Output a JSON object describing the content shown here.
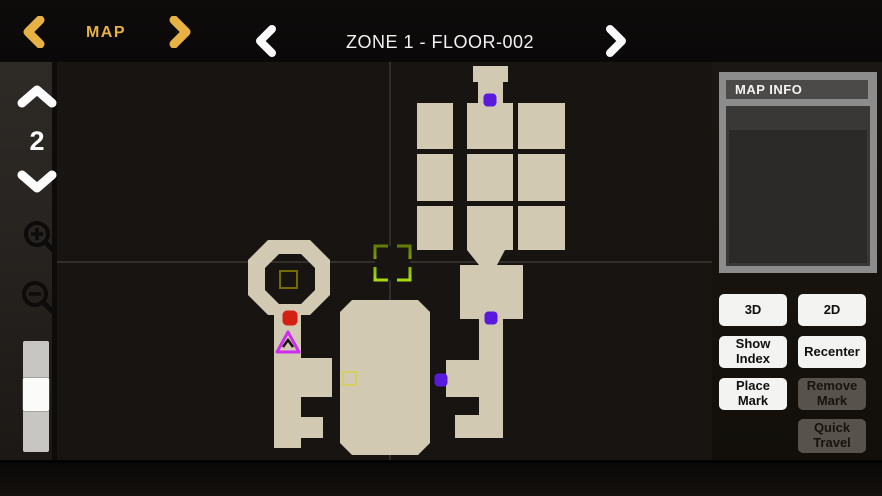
{
  "topbar": {
    "menu_label": "MAP",
    "floor_title": "ZONE 1 - FLOOR-002"
  },
  "sidebar": {
    "floor_number": "2"
  },
  "map_info": {
    "title": "MAP INFO"
  },
  "buttons": {
    "view_3d": "3D",
    "view_2d": "2D",
    "show_index": "Show Index",
    "recenter": "Recenter",
    "place_mark": "Place Mark",
    "remove_mark": "Remove Mark",
    "quick_travel": "Quick Travel"
  },
  "icons": {
    "topbar_left": "chevron-left",
    "topbar_right": "chevron-right",
    "floor_up": "chevron-up",
    "floor_down": "chevron-down",
    "zoom_in": "magnifier-plus",
    "zoom_out": "magnifier-minus"
  },
  "colors": {
    "accent_gold": "#e7b243",
    "room_fill": "#d2c9b3",
    "map_background": "#171411",
    "red_mark": "#d32013",
    "purple_mark": "#5a1add",
    "triangle_mark": "#cf2cf2",
    "selection_top": "#637d04",
    "selection_bottom": "#a7d911",
    "olive_square": "#746c00",
    "yellow_square": "#d8cf4a",
    "crosshair": "rgba(215,210,198,0.28)"
  },
  "map": {
    "viewport": {
      "w": 655,
      "h": 398
    },
    "crosshair": {
      "x": 333,
      "y": 200
    },
    "rooms": [
      {
        "type": "rect",
        "x": 416,
        "y": 4,
        "w": 35,
        "h": 16
      },
      {
        "type": "rect",
        "x": 421,
        "y": 20,
        "w": 25,
        "h": 21
      },
      {
        "type": "rect",
        "x": 360,
        "y": 41,
        "w": 36,
        "h": 46
      },
      {
        "type": "rect",
        "x": 410,
        "y": 41,
        "w": 46,
        "h": 46
      },
      {
        "type": "rect",
        "x": 461,
        "y": 41,
        "w": 47,
        "h": 46
      },
      {
        "type": "rect",
        "x": 360,
        "y": 92,
        "w": 36,
        "h": 47
      },
      {
        "type": "rect",
        "x": 410,
        "y": 92,
        "w": 46,
        "h": 47
      },
      {
        "type": "rect",
        "x": 461,
        "y": 92,
        "w": 47,
        "h": 47
      },
      {
        "type": "rect",
        "x": 360,
        "y": 144,
        "w": 36,
        "h": 44
      },
      {
        "type": "rect",
        "x": 410,
        "y": 144,
        "w": 46,
        "h": 44
      },
      {
        "type": "rect",
        "x": 461,
        "y": 144,
        "w": 47,
        "h": 44
      },
      {
        "type": "poly",
        "points": "410,188 448,188 440,203 422,203"
      },
      {
        "type": "rect",
        "x": 403,
        "y": 203,
        "w": 63,
        "h": 54
      },
      {
        "type": "rect",
        "x": 422,
        "y": 255,
        "w": 24,
        "h": 121
      },
      {
        "type": "rect",
        "x": 389,
        "y": 298,
        "w": 34,
        "h": 37
      },
      {
        "type": "rect",
        "x": 398,
        "y": 353,
        "w": 25,
        "h": 23
      },
      {
        "type": "poly",
        "points": "295,238 361,238 373,250 373,381 361,393 295,393 283,381 283,250"
      },
      {
        "type": "rect",
        "x": 217,
        "y": 248,
        "w": 27,
        "h": 138
      },
      {
        "type": "rect",
        "x": 244,
        "y": 296,
        "w": 31,
        "h": 39
      },
      {
        "type": "rect",
        "x": 244,
        "y": 355,
        "w": 22,
        "h": 21
      },
      {
        "type": "poly",
        "points": "211,178 253,178 273,198 273,233 253,253 211,253 191,233 191,198"
      }
    ],
    "holes": [
      {
        "type": "poly",
        "points": "222,192 244,192 258,206 258,228 244,242 222,242 208,228 208,206"
      }
    ],
    "overlays": [
      {
        "kind": "selection",
        "x": 318,
        "y": 184,
        "w": 35,
        "h": 34
      },
      {
        "kind": "square",
        "x": 223,
        "y": 209,
        "w": 17,
        "h": 17,
        "color": "#746c00",
        "width": 2
      },
      {
        "kind": "square",
        "x": 286,
        "y": 310,
        "w": 13,
        "h": 13,
        "color": "#d8cf4a",
        "width": 1.5
      }
    ],
    "markers": [
      {
        "shape": "square",
        "name": "red-mark",
        "x": 233,
        "y": 256,
        "size": 15,
        "color": "#d32013"
      },
      {
        "shape": "square",
        "name": "purple-mark-1",
        "x": 433,
        "y": 38,
        "size": 13,
        "color": "#5a1add"
      },
      {
        "shape": "square",
        "name": "purple-mark-2",
        "x": 434,
        "y": 256,
        "size": 13,
        "color": "#5a1add"
      },
      {
        "shape": "square",
        "name": "purple-mark-3",
        "x": 384,
        "y": 318,
        "size": 13,
        "color": "#5a1add"
      },
      {
        "shape": "triangle",
        "name": "player-marker",
        "x": 231,
        "y": 280,
        "color": "#cf2cf2"
      }
    ]
  }
}
